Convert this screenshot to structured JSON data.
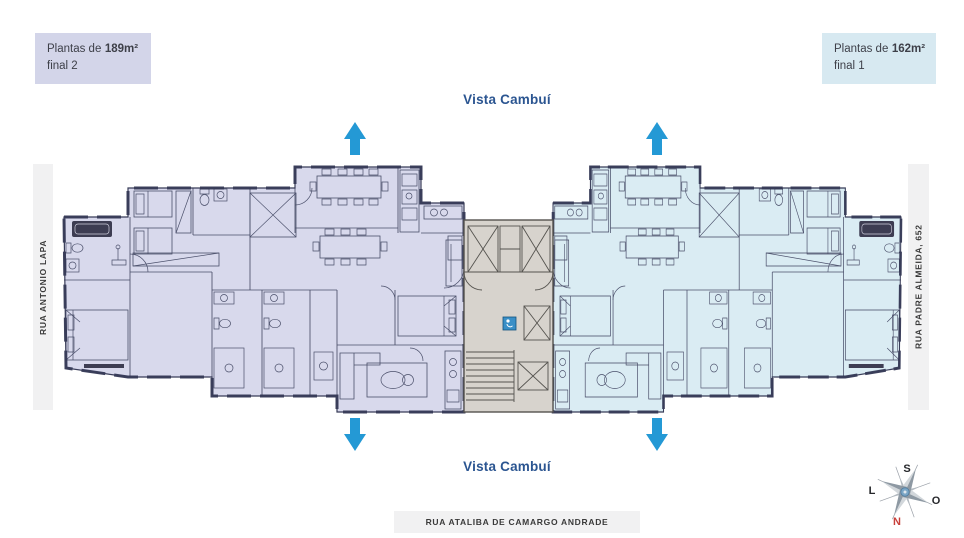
{
  "unit_labels": {
    "left": {
      "prefix": "Plantas de",
      "area": "189m²",
      "final": "final 2",
      "bg": "#d3d5e9"
    },
    "right": {
      "prefix": "Plantas de",
      "area": "162m²",
      "final": "final 1",
      "bg": "#d7e9f1"
    }
  },
  "views": {
    "top": "Vista Cambuí",
    "bottom": "Vista Cambuí",
    "text_color": "#2b5591"
  },
  "streets": {
    "left": "RUA ANTONIO LAPA",
    "right": "RUA PADRE ALMEIDA, 652",
    "bottom": "RUA ATALIBA DE CAMARGO ANDRADE"
  },
  "compass": {
    "top": "S",
    "left": "L",
    "right": "O",
    "bottom": "N",
    "north_color": "#c8403a"
  },
  "floorplan": {
    "left_unit_fill": "#d8d9ec",
    "right_unit_fill": "#daecf3",
    "core_fill": "#d7d3cd",
    "wall_color": "#383c58",
    "view_arrow_color": "#2499d5",
    "elevator_icon_color": "#3a8fc7"
  }
}
